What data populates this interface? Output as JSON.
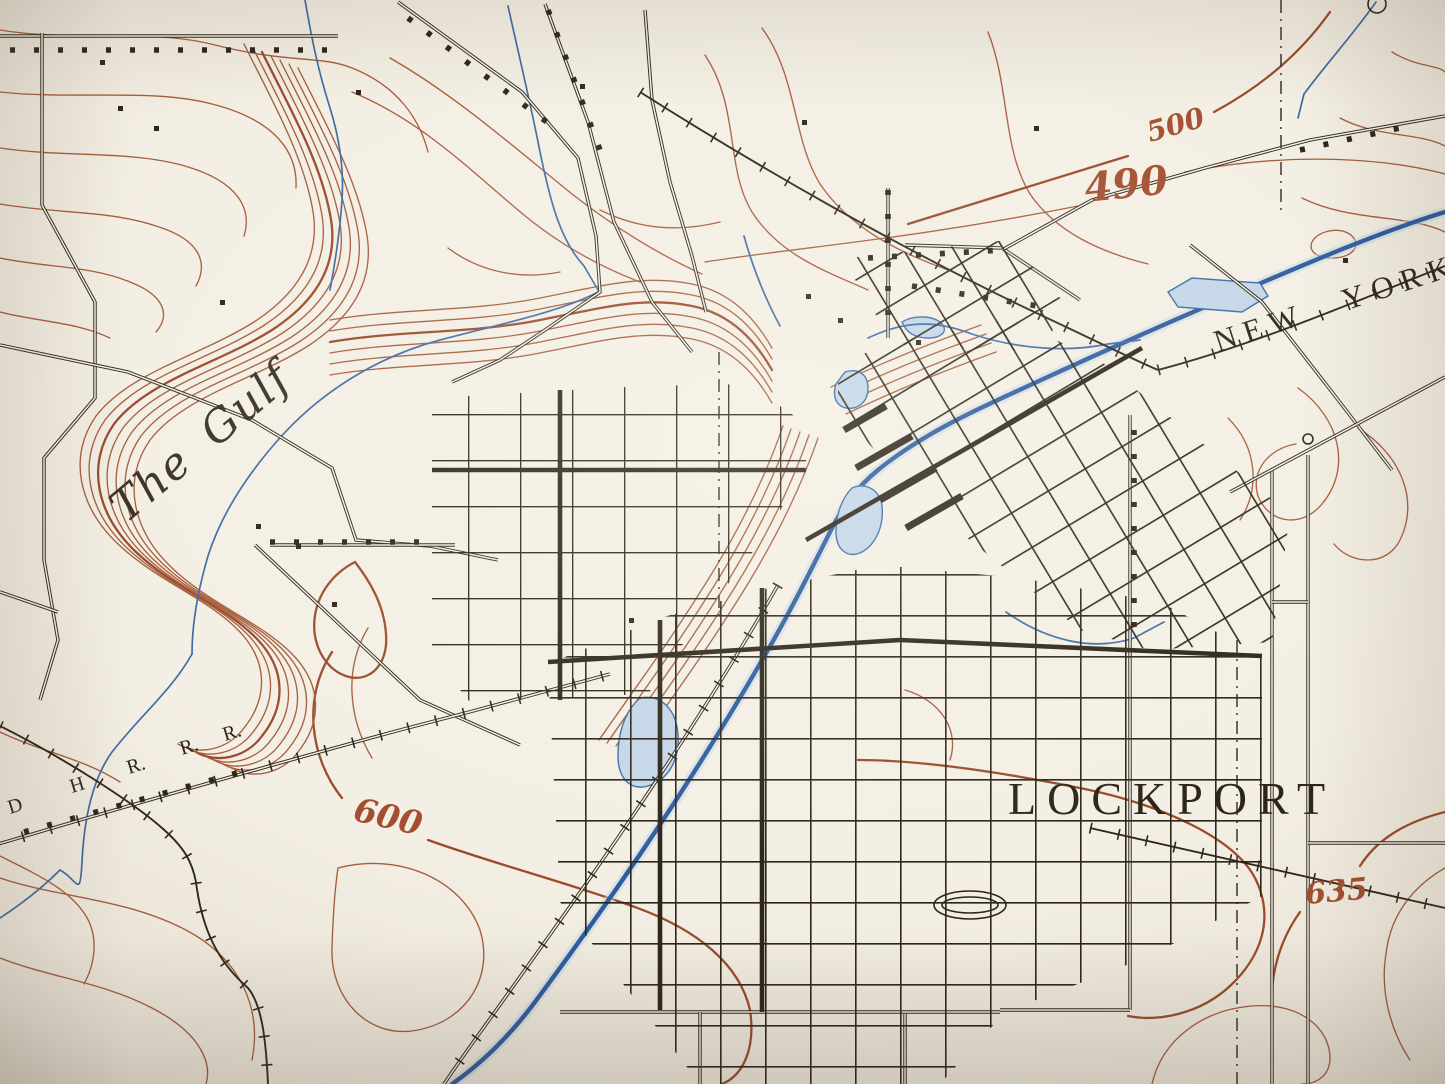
{
  "palette": {
    "paper": "#f4efe4",
    "contour": "#a65d3c",
    "contour_index": "#9a4b2b",
    "label_brown": "#a34e30",
    "water": "#3f6ba6",
    "water_deep": "#2e5d9e",
    "water_fill": "#c3d6e8",
    "ink": "#2c2519",
    "ink_soft": "#3a3226"
  },
  "labels": {
    "the_gulf": "The Gulf",
    "lockport": "LOCKPORT",
    "new_york": "NEW YORK",
    "contour_500": "500",
    "contour_490": "490",
    "contour_600": "600",
    "contour_635": "635",
    "rr_d": "D",
    "rr_h": "H",
    "rr_r1": "R.",
    "rr_r2": "R.",
    "rr_r3": "R."
  }
}
